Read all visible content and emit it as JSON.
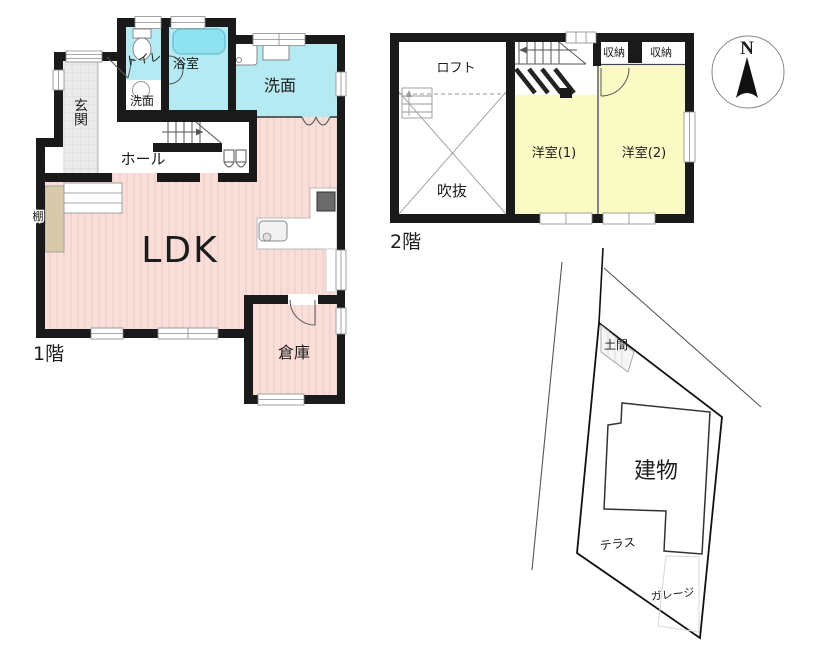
{
  "colors": {
    "wall": "#1a1a1a",
    "pink": "#f9ded9",
    "pink_stripe": "#f0cdc7",
    "cyan": "#b6eaf3",
    "bathtub": "#8fe2ef",
    "yellow": "#fafac4",
    "genkan_gray": "#ebebeb",
    "genkan_grid": "#d9d9d9",
    "shelf_tan": "#d9c9ab",
    "stove": "#6b6b6b"
  },
  "floor1": {
    "label": "1階",
    "rooms": {
      "ldk": "LDK",
      "genkan": "玄関",
      "hall": "ホール",
      "toilet": "トイレ",
      "bath": "浴室",
      "washroom_small": "洗面",
      "washroom": "洗面",
      "shelf": "棚",
      "storage": "倉庫"
    }
  },
  "floor2": {
    "label": "2階",
    "rooms": {
      "loft": "ロフト",
      "void": "吹抜",
      "western1": "洋室(1)",
      "western2": "洋室(2)",
      "closet1": "収納",
      "closet2": "収納"
    }
  },
  "site_plan": {
    "building": "建物",
    "doma": "土間",
    "terrace": "テラス",
    "garage": "ガレージ"
  },
  "compass": {
    "north": "N"
  }
}
